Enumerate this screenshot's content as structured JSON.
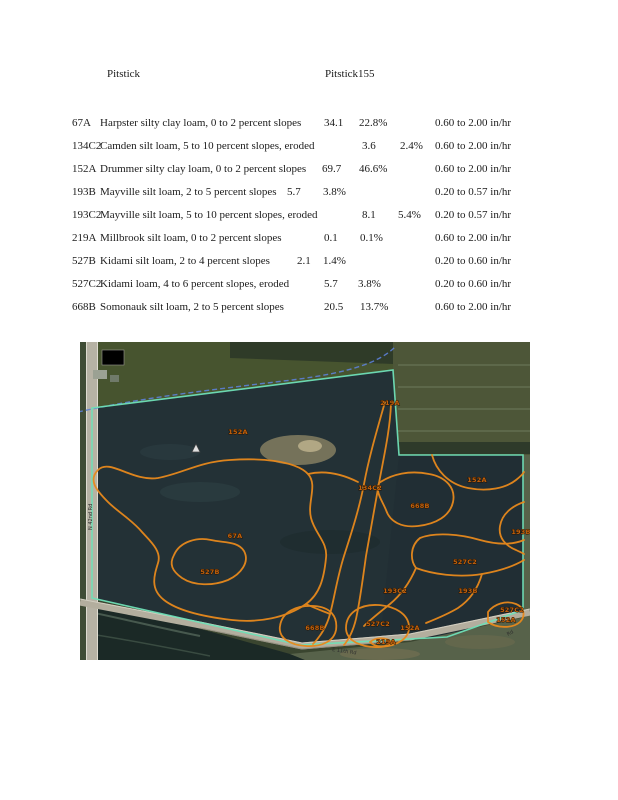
{
  "header": {
    "title_left": "Pitstick",
    "title_right": "Pitstick155"
  },
  "table": {
    "rows": [
      {
        "code": "67A",
        "desc": "Harpster silty clay loam, 0 to 2 percent slopes",
        "acres": "34.1",
        "pct": "22.8%",
        "rate": "0.60 to 2.00 in/hr",
        "acres_x": 324,
        "pct_x": 359
      },
      {
        "code": "134C2",
        "desc": "Camden silt loam, 5 to 10 percent slopes, eroded",
        "acres": "3.6",
        "pct": "2.4%",
        "rate": "0.60 to 2.00 in/hr",
        "acres_x": 362,
        "pct_x": 400
      },
      {
        "code": "152A",
        "desc": "Drummer silty clay loam, 0 to 2 percent slopes",
        "acres": "69.7",
        "pct": "46.6%",
        "rate": "0.60 to 2.00 in/hr",
        "acres_x": 322,
        "pct_x": 359
      },
      {
        "code": "193B",
        "desc": "Mayville silt loam, 2 to 5 percent slopes",
        "acres": "5.7",
        "pct": "3.8%",
        "rate": "0.20 to 0.57 in/hr",
        "acres_x": 287,
        "pct_x": 323
      },
      {
        "code": "193C2",
        "desc": "Mayville silt loam, 5 to 10 percent slopes, eroded",
        "acres": "8.1",
        "pct": "5.4%",
        "rate": "0.20 to 0.57 in/hr",
        "acres_x": 362,
        "pct_x": 398
      },
      {
        "code": "219A",
        "desc": "Millbrook silt loam, 0 to 2 percent slopes",
        "acres": "0.1",
        "pct": "0.1%",
        "rate": "0.60 to 2.00 in/hr",
        "acres_x": 324,
        "pct_x": 360
      },
      {
        "code": "527B",
        "desc": "Kidami silt loam, 2 to 4 percent slopes",
        "acres": "2.1",
        "pct": "1.4%",
        "rate": "0.20 to 0.60 in/hr",
        "acres_x": 297,
        "pct_x": 323
      },
      {
        "code": "527C2",
        "desc": "Kidami loam, 4 to 6 percent slopes, eroded",
        "acres": "5.7",
        "pct": "3.8%",
        "rate": "0.20 to 0.60 in/hr",
        "acres_x": 324,
        "pct_x": 358
      },
      {
        "code": "668B",
        "desc": "Somonauk silt loam, 2 to 5 percent slopes",
        "acres": "20.5",
        "pct": "13.7%",
        "rate": "0.60 to 2.00 in/hr",
        "acres_x": 324,
        "pct_x": 360
      }
    ]
  },
  "map": {
    "labels": [
      {
        "text": "152A",
        "x": 158,
        "y": 92
      },
      {
        "text": "219A",
        "x": 310,
        "y": 63
      },
      {
        "text": "134C2",
        "x": 290,
        "y": 148
      },
      {
        "text": "668B",
        "x": 340,
        "y": 166
      },
      {
        "text": "152A",
        "x": 397,
        "y": 140
      },
      {
        "text": "67A",
        "x": 155,
        "y": 196
      },
      {
        "text": "527B",
        "x": 130,
        "y": 232
      },
      {
        "text": "193B",
        "x": 441,
        "y": 192
      },
      {
        "text": "527C2",
        "x": 385,
        "y": 222
      },
      {
        "text": "193C2",
        "x": 315,
        "y": 251
      },
      {
        "text": "193B",
        "x": 388,
        "y": 251
      },
      {
        "text": "668B",
        "x": 235,
        "y": 288
      },
      {
        "text": "527C2",
        "x": 298,
        "y": 284
      },
      {
        "text": "152A",
        "x": 330,
        "y": 288
      },
      {
        "text": "219A",
        "x": 306,
        "y": 302
      },
      {
        "text": "527C2",
        "x": 432,
        "y": 270
      },
      {
        "text": "152A",
        "x": 426,
        "y": 280
      }
    ],
    "road_label_left": "N 42nd Rd",
    "road_label_bottom": "E 11th Rd",
    "road_label_corner": "Rd",
    "colors": {
      "parcel_boundary": "#6fdfb7",
      "soil_line": "#e8891c",
      "soil_label": "#c2610c",
      "stream": "#5c7fd6"
    }
  }
}
